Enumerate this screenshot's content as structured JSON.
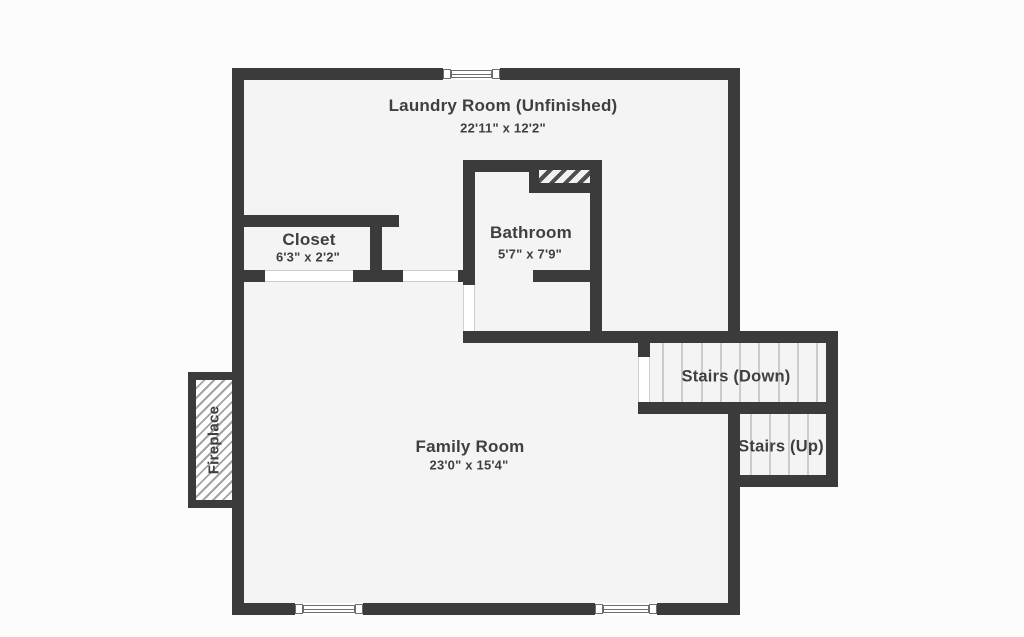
{
  "plan_type": "floor-plan",
  "colors": {
    "wall": "#3b3b3b",
    "floor": "#f4f4f4",
    "page": "#fcfcfc",
    "text": "#3f3f3f",
    "tread": "#cccccc",
    "openline": "#cfcfcf",
    "winline": "#6e6e6e",
    "hatch": "#a3a3a3",
    "hatchdark": "#4e4e4e"
  },
  "rooms": {
    "laundry": {
      "label": "Laundry Room (Unfinished)",
      "dims": "22'11\" x 12'2\""
    },
    "closet": {
      "label": "Closet",
      "dims": "6'3\" x 2'2\""
    },
    "bathroom": {
      "label": "Bathroom",
      "dims": "5'7\" x 7'9\""
    },
    "family": {
      "label": "Family Room",
      "dims": "23'0\" x 15'4\""
    }
  },
  "stairs": {
    "down": {
      "label": "Stairs (Down)"
    },
    "up": {
      "label": "Stairs (Up)"
    }
  },
  "fireplace": {
    "label": "Fireplace"
  }
}
